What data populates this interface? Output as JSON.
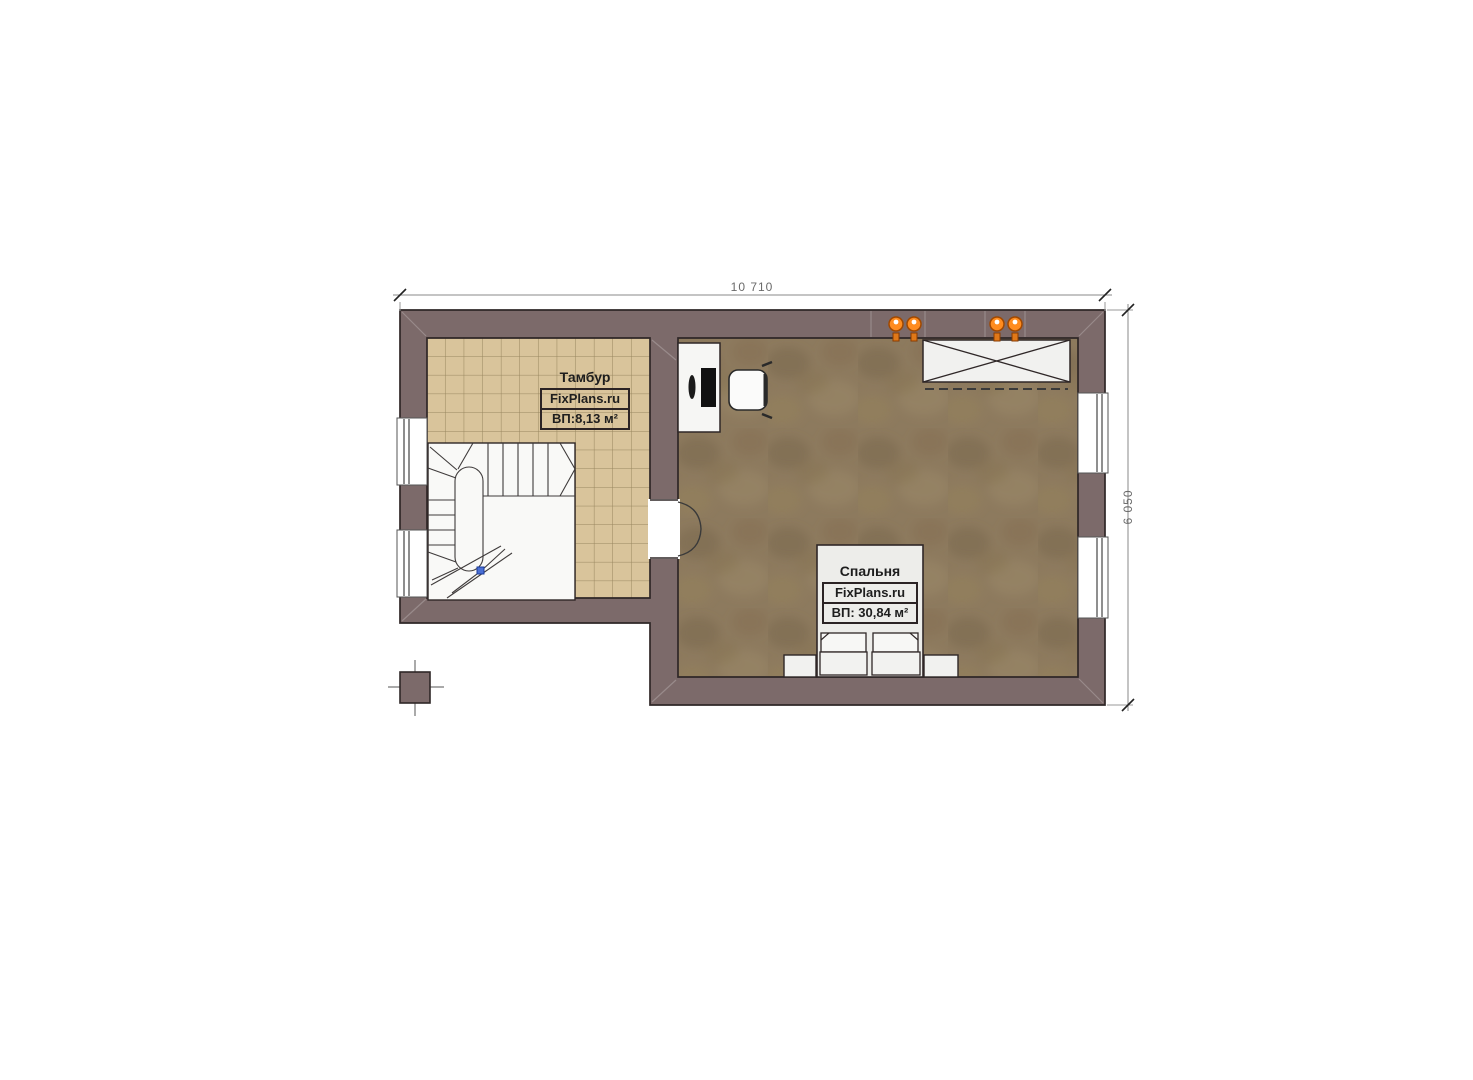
{
  "plan": {
    "rooms": {
      "tambour": {
        "name": "Тамбур",
        "brand": "FixPlans.ru",
        "area": "ВП:8,13 м²"
      },
      "bedroom": {
        "name": "Спальня",
        "brand": "FixPlans.ru",
        "area": "ВП: 30,84 м²"
      }
    },
    "dimensions": {
      "top": "10 710",
      "right": "6 050"
    },
    "colors": {
      "wall": "#7c6a6a",
      "outline": "#2f2727",
      "tile_floor": "#d9c49b",
      "tile_grid": "#98865f",
      "bedroom_floor": "#8d7a5e",
      "furniture": "#f4f4f2",
      "lamp_orange": "#ff8c1f",
      "stair_marker_blue": "#4a6fd4",
      "dimension_text": "#6a6a6a"
    }
  }
}
